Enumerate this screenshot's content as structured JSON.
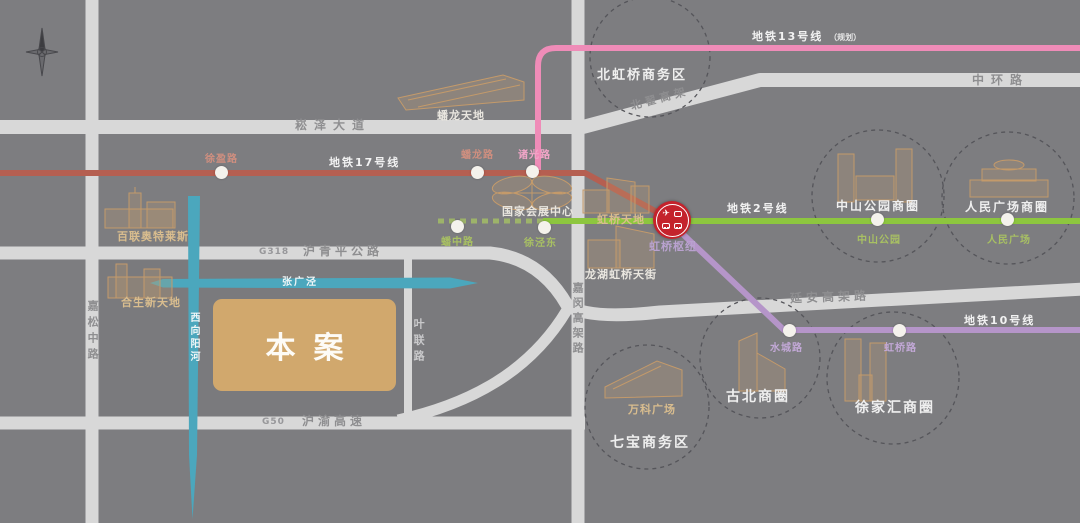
{
  "map_type": "project location map",
  "site": {
    "label": "本案"
  },
  "hub": {
    "label": "虹桥枢纽",
    "icon": "transport-hub-icon"
  },
  "colors": {
    "background": "#7d7d80",
    "road": "#d8d8d8",
    "river": "#4ba7bd",
    "site_block": "#d1a86d",
    "hub_red": "#c4232c",
    "line17": "#b55f51",
    "line13": "#ef8cb8",
    "line2": "#8dc63f",
    "line10": "#b595c9"
  },
  "metro_lines": [
    {
      "id": "line17",
      "name": "地铁17号线",
      "color": "#b55f51"
    },
    {
      "id": "line13",
      "name": "地铁13号线",
      "suffix": "（规划）",
      "color": "#ef8cb8"
    },
    {
      "id": "line2",
      "name": "地铁2号线",
      "color": "#8dc63f"
    },
    {
      "id": "line10",
      "name": "地铁10号线",
      "color": "#b595c9"
    }
  ],
  "stations": [
    {
      "name": "徐盈路",
      "line": "line17"
    },
    {
      "name": "蟠龙路",
      "line": "line17"
    },
    {
      "name": "诸光路",
      "line": "line13"
    },
    {
      "name": "蟠中路",
      "line": "line2"
    },
    {
      "name": "徐泾东",
      "line": "line2"
    },
    {
      "name": "中山公园",
      "line": "line2"
    },
    {
      "name": "人民广场",
      "line": "line2"
    },
    {
      "name": "水城路",
      "line": "line10"
    },
    {
      "name": "虹桥路",
      "line": "line10"
    }
  ],
  "roads": [
    {
      "name": "崧泽大道"
    },
    {
      "name": "北翟高架"
    },
    {
      "name": "中环路"
    },
    {
      "code": "G318",
      "name": "沪青平公路"
    },
    {
      "code": "G50",
      "name": "沪渝高速"
    },
    {
      "name": "延安高架路"
    },
    {
      "name": "嘉松中路"
    },
    {
      "name": "叶联路"
    },
    {
      "name": "嘉闵高架路"
    }
  ],
  "rivers": [
    {
      "name": "张广泾"
    },
    {
      "name": "西向阳河"
    }
  ],
  "landmarks": [
    {
      "name": "百联奥特莱斯"
    },
    {
      "name": "蟠龙天地"
    },
    {
      "name": "国家会展中心"
    },
    {
      "name": "虹桥天地"
    },
    {
      "name": "龙湖虹桥天街"
    },
    {
      "name": "合生新天地"
    },
    {
      "name": "万科广场"
    }
  ],
  "districts": [
    {
      "name": "北虹桥商务区"
    },
    {
      "name": "中山公园商圈"
    },
    {
      "name": "人民广场商圈"
    },
    {
      "name": "古北商圈"
    },
    {
      "name": "徐家汇商圈"
    },
    {
      "name": "七宝商务区"
    }
  ]
}
